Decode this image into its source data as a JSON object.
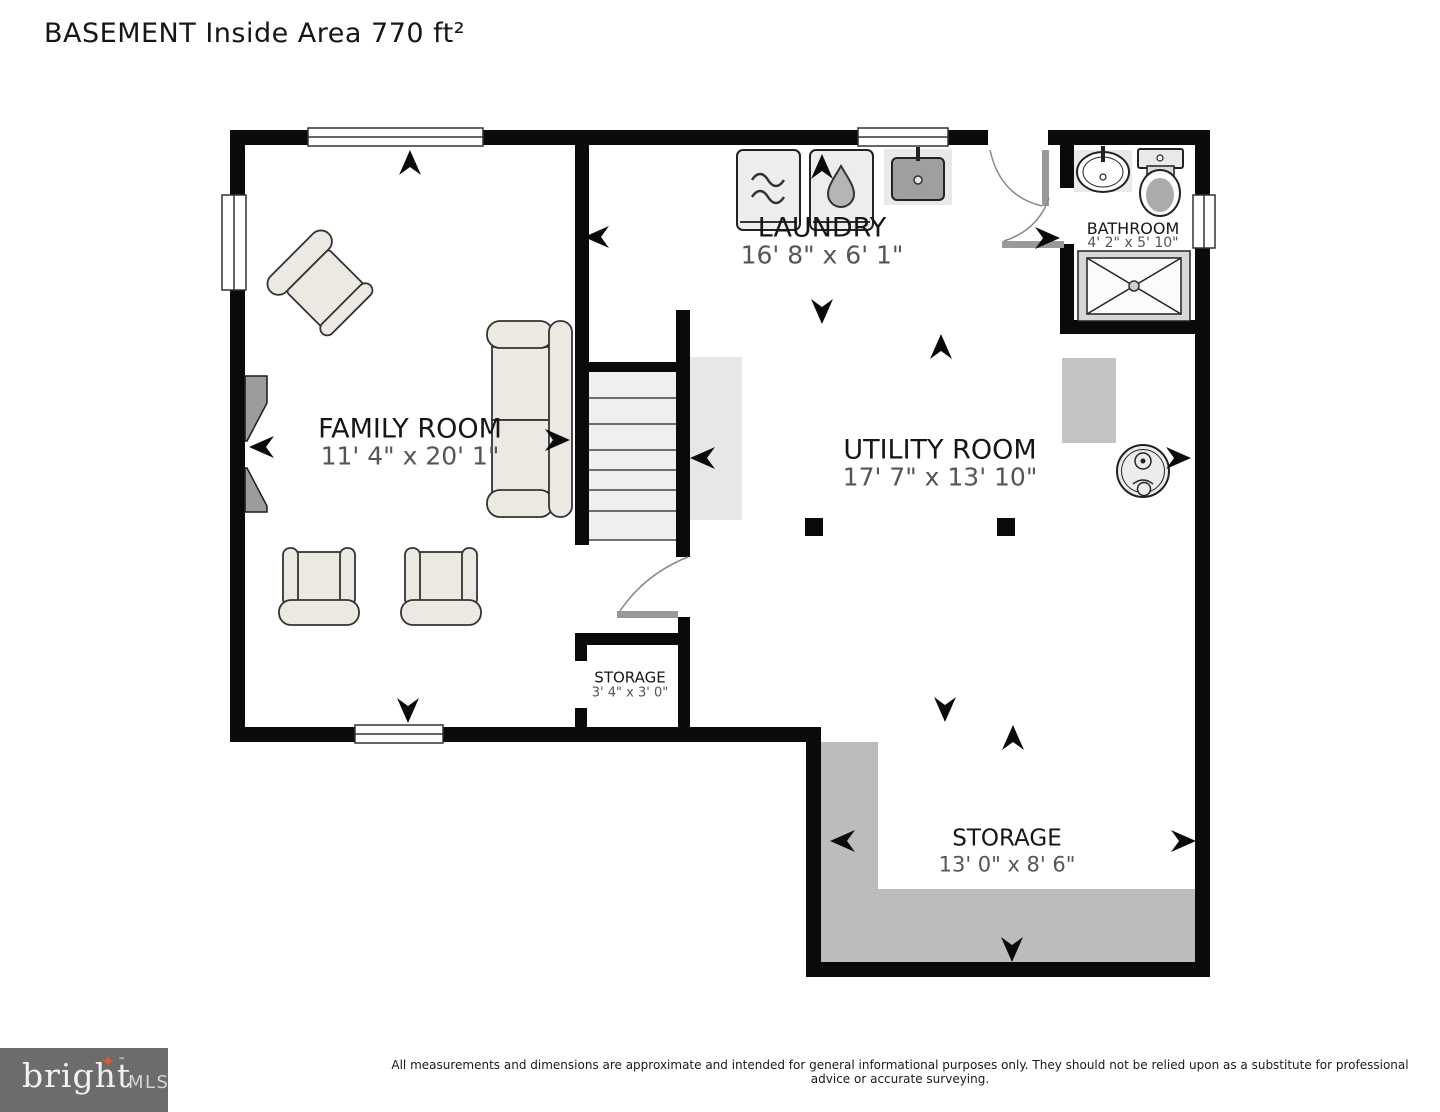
{
  "title": "BASEMENT Inside Area 770 ft²",
  "rooms": {
    "family": {
      "name": "FAMILY ROOM",
      "dims": "11' 4\" x 20' 1\""
    },
    "laundry": {
      "name": "LAUNDRY",
      "dims": "16' 8\" x 6' 1\""
    },
    "bathroom": {
      "name": "BATHROOM",
      "dims": "4' 2\" x 5' 10\""
    },
    "utility": {
      "name": "UTILITY ROOM",
      "dims": "17' 7\" x 13' 10\""
    },
    "storage_closet": {
      "name": "STORAGE",
      "dims": "3' 4\" x 3' 0\""
    },
    "storage": {
      "name": "STORAGE",
      "dims": "13' 0\" x 8' 6\""
    }
  },
  "footer": {
    "logo_primary": "bright",
    "logo_secondary": "MLS",
    "logo_star": "✦",
    "logo_tm": "™",
    "disclaimer": "All measurements and dimensions are approximate and intended for general informational purposes only. They should not be relied upon as a substitute for professional advice or accurate surveying."
  },
  "colors": {
    "wall": "#0a0a0a",
    "dims_text": "#555555",
    "floor_shade": "#bcbcbc",
    "fixture_fill": "#ececec",
    "logo_background": "#6c6c6c",
    "logo_accent": "#dd5b2f"
  }
}
